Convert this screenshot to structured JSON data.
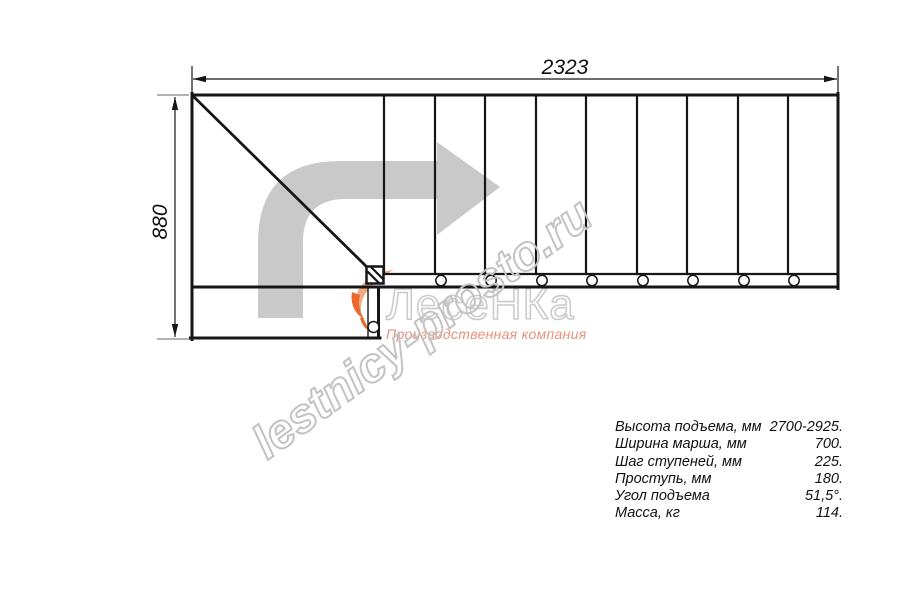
{
  "plan": {
    "title": "staircase top-view plan with quarter turn",
    "width_dim_label": "2323",
    "height_dim_label": "880",
    "tread_line_count": 9,
    "baluster_circle_count": 9,
    "line_color": "#161616",
    "travel_arrow_color": "#c9c9c9"
  },
  "watermark": {
    "text": "lestnicy-prosto.ru",
    "color": "#c3c3c3"
  },
  "logo": {
    "name": "ЛесеНКа",
    "subtitle": "Производственная компания",
    "name_color": "#cbcbcb",
    "subtitle_color": "#e8907a",
    "flame_color": "#f3a87e"
  },
  "specs": {
    "rows": [
      {
        "label": "Высота подъема, мм",
        "value": "2700-2925."
      },
      {
        "label": "Ширина марша, мм",
        "value": "700."
      },
      {
        "label": "Шаг ступеней, мм",
        "value": "225."
      },
      {
        "label": "Проступь, мм",
        "value": "180."
      },
      {
        "label": "Угол подъема",
        "value": "51,5°."
      },
      {
        "label": "Масса, кг",
        "value": "114."
      }
    ]
  }
}
